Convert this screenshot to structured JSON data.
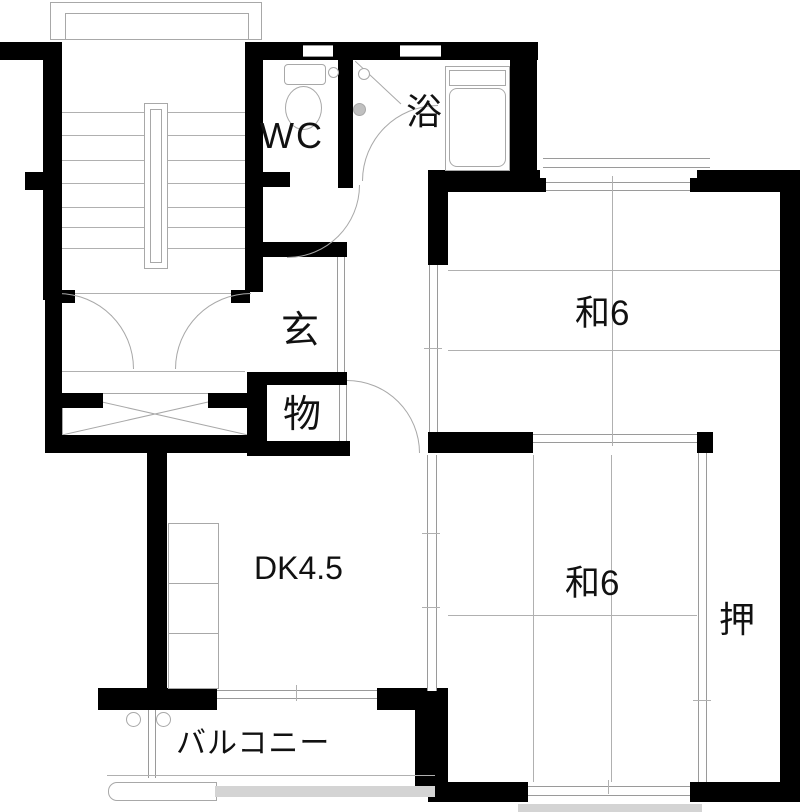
{
  "plan": {
    "type": "floor-plan",
    "rooms": {
      "wc": {
        "label": "WC"
      },
      "bath": {
        "label": "浴"
      },
      "entrance": {
        "label": "玄"
      },
      "storage": {
        "label": "物"
      },
      "tatami_upper": {
        "label": "和6"
      },
      "tatami_lower": {
        "label": "和6"
      },
      "closet": {
        "label": "押"
      },
      "dining_kitchen": {
        "label": "DK4.5"
      },
      "balcony": {
        "label": "バルコニー"
      }
    },
    "colors": {
      "wall": "#000000",
      "line": "#a8a8a8",
      "background": "#ffffff",
      "text": "#111111"
    }
  }
}
